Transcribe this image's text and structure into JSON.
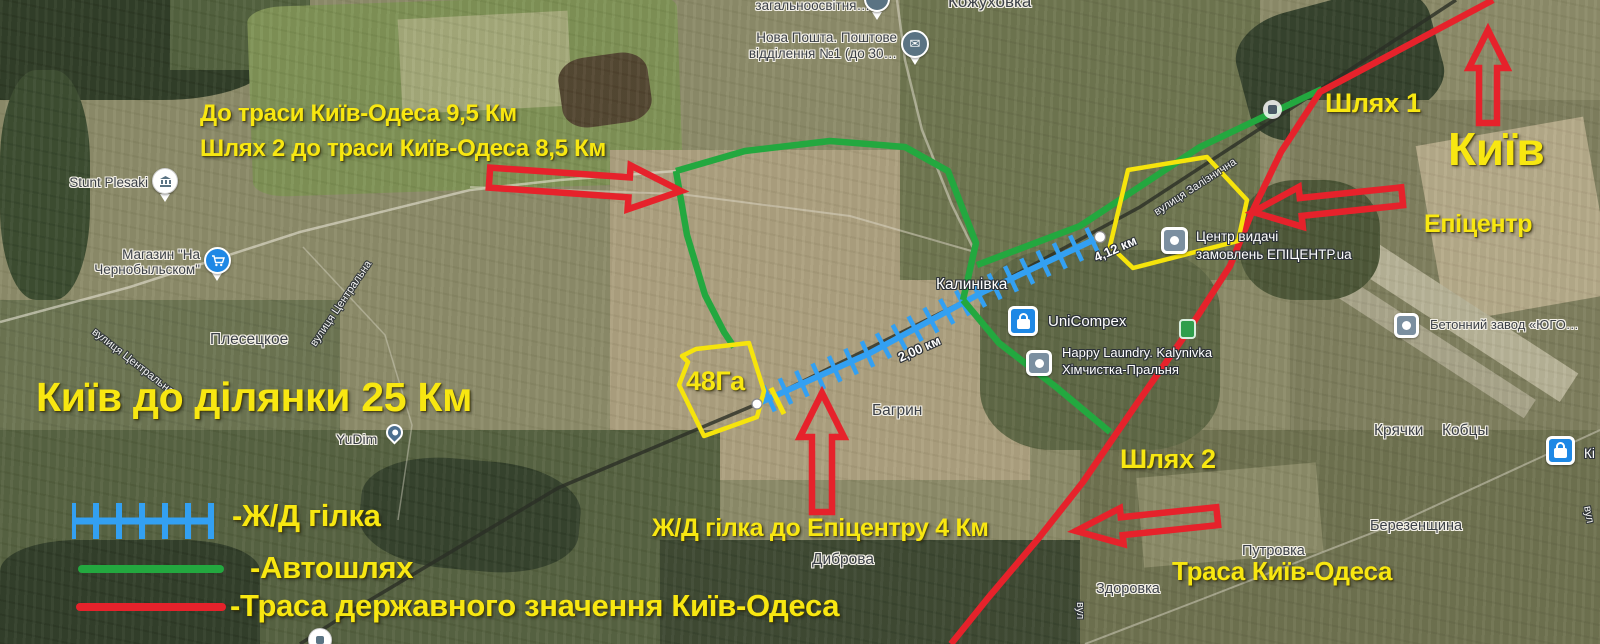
{
  "colors": {
    "annotation_yellow": "#f8e711",
    "arrow_red": "#e6222b",
    "railway_blue": "#33a0f2",
    "road_green": "#23a83f",
    "highway_red": "#e6222b",
    "parcel_yellow": "#f6e40c"
  },
  "annotations": {
    "dist_line1": "До траси Київ-Одеса 9,5 Км",
    "dist_line2": "Шлях 2 до траси Київ-Одеса 8,5 Км",
    "path1": "Шлях 1",
    "path2": "Шлях 2",
    "kyiv": "Київ",
    "epicentr": "Епіцентр",
    "kyiv_to_plot": "Київ до ділянки 25 Км",
    "plot_area": "48Га",
    "rail_branch": "Ж/Д гілка до Епіцентру 4 Км",
    "highway_label": "Траса Київ-Одеса"
  },
  "legend": {
    "railway": "-Ж/Д гілка",
    "road": "-Автошлях",
    "highway": "-Траса державного значення Київ-Одеса"
  },
  "places": {
    "kozhukhovka": "Кожуховка",
    "school": "загальноосвітня…",
    "nova_poshta_l1": "Нова Пошта. Поштове",
    "nova_poshta_l2": "відділення №1 (до 30…",
    "stunt_plesaki": "Stunt Plesaki",
    "shop_l1": "Магазин \"На",
    "shop_l2": "Чернобыльском\"",
    "plesetske": "Плесецкое",
    "kalynivka": "Калинівка",
    "unicompex": "UniCompex",
    "laundry_l1": "Happy Laundry. Kalynivka",
    "laundry_l2": "Хімчистка-Пральня",
    "epicentr_l1": "Центр видачі",
    "epicentr_l2": "замовлень ЕПІЦЕНТР.ua",
    "concrete": "Бетонний завод «ЮГО…",
    "kriachky": "Крячки",
    "kobtsy": "Кобцы",
    "berezenshchyna": "Березенщина",
    "putrovka": "Путровка",
    "zdorovka": "Здоровка",
    "dybrova": "Диброва",
    "bahryn": "Багрин",
    "yudim": "YuDim",
    "store_partial": "Кі"
  },
  "streets": {
    "centralna_a": "вулиця Центральна",
    "centralna_b": "вулиця Центральна",
    "zaliznychna": "вулиця Залізнична",
    "vul_a": "вул",
    "vul_b": "вул"
  },
  "measurements": {
    "to_epicentr": "4,12 км",
    "to_plot": "2,00 км"
  },
  "icons": {
    "school_pin": "circle-pin",
    "nova_poshta": "envelope",
    "stunt_plesaki": "museum-building",
    "shop": "shopping-cart",
    "unicompex": "shopping-bag",
    "laundry": "square-dot",
    "epicentr_pickup": "square-dot",
    "concrete_plant": "square-dot",
    "yudim": "teardrop-pin",
    "store_right": "shopping-bag",
    "road_poi": "transit-stop",
    "gas_badge": "green-badge",
    "bottom_pin": "circle-pin"
  }
}
